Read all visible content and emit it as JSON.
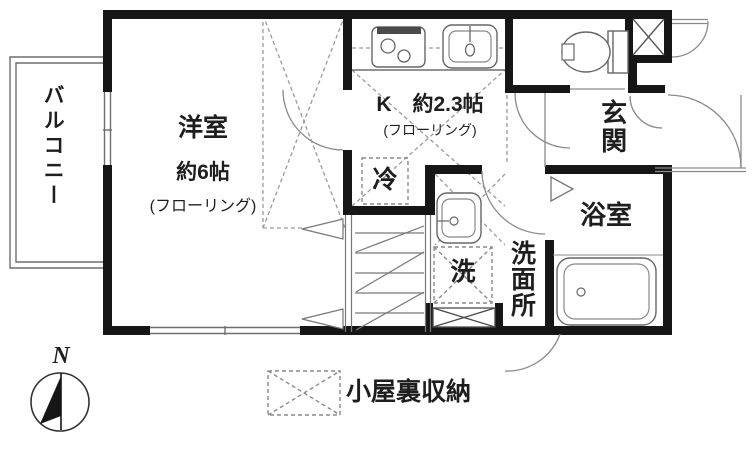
{
  "floorplan": {
    "balcony": {
      "label": "バルコニー"
    },
    "western_room": {
      "label": "洋室",
      "size": "約6帖",
      "floor_note": "(フローリング)"
    },
    "kitchen": {
      "label": "K　約2.3帖",
      "floor_note": "(フローリング)"
    },
    "refrigerator": {
      "label": "冷"
    },
    "entrance": {
      "label": "玄関"
    },
    "bathroom": {
      "label": "浴室"
    },
    "washroom": {
      "label": "洗面所"
    },
    "washer": {
      "label": "洗"
    },
    "legend": {
      "label": "小屋裏収納"
    },
    "compass": {
      "label": "N"
    }
  },
  "colors": {
    "wall": "#161616",
    "thin_line": "#6e6e6e",
    "dash_line": "#9a9a9a",
    "text": "#1e1e1e",
    "background": "#ffffff"
  }
}
